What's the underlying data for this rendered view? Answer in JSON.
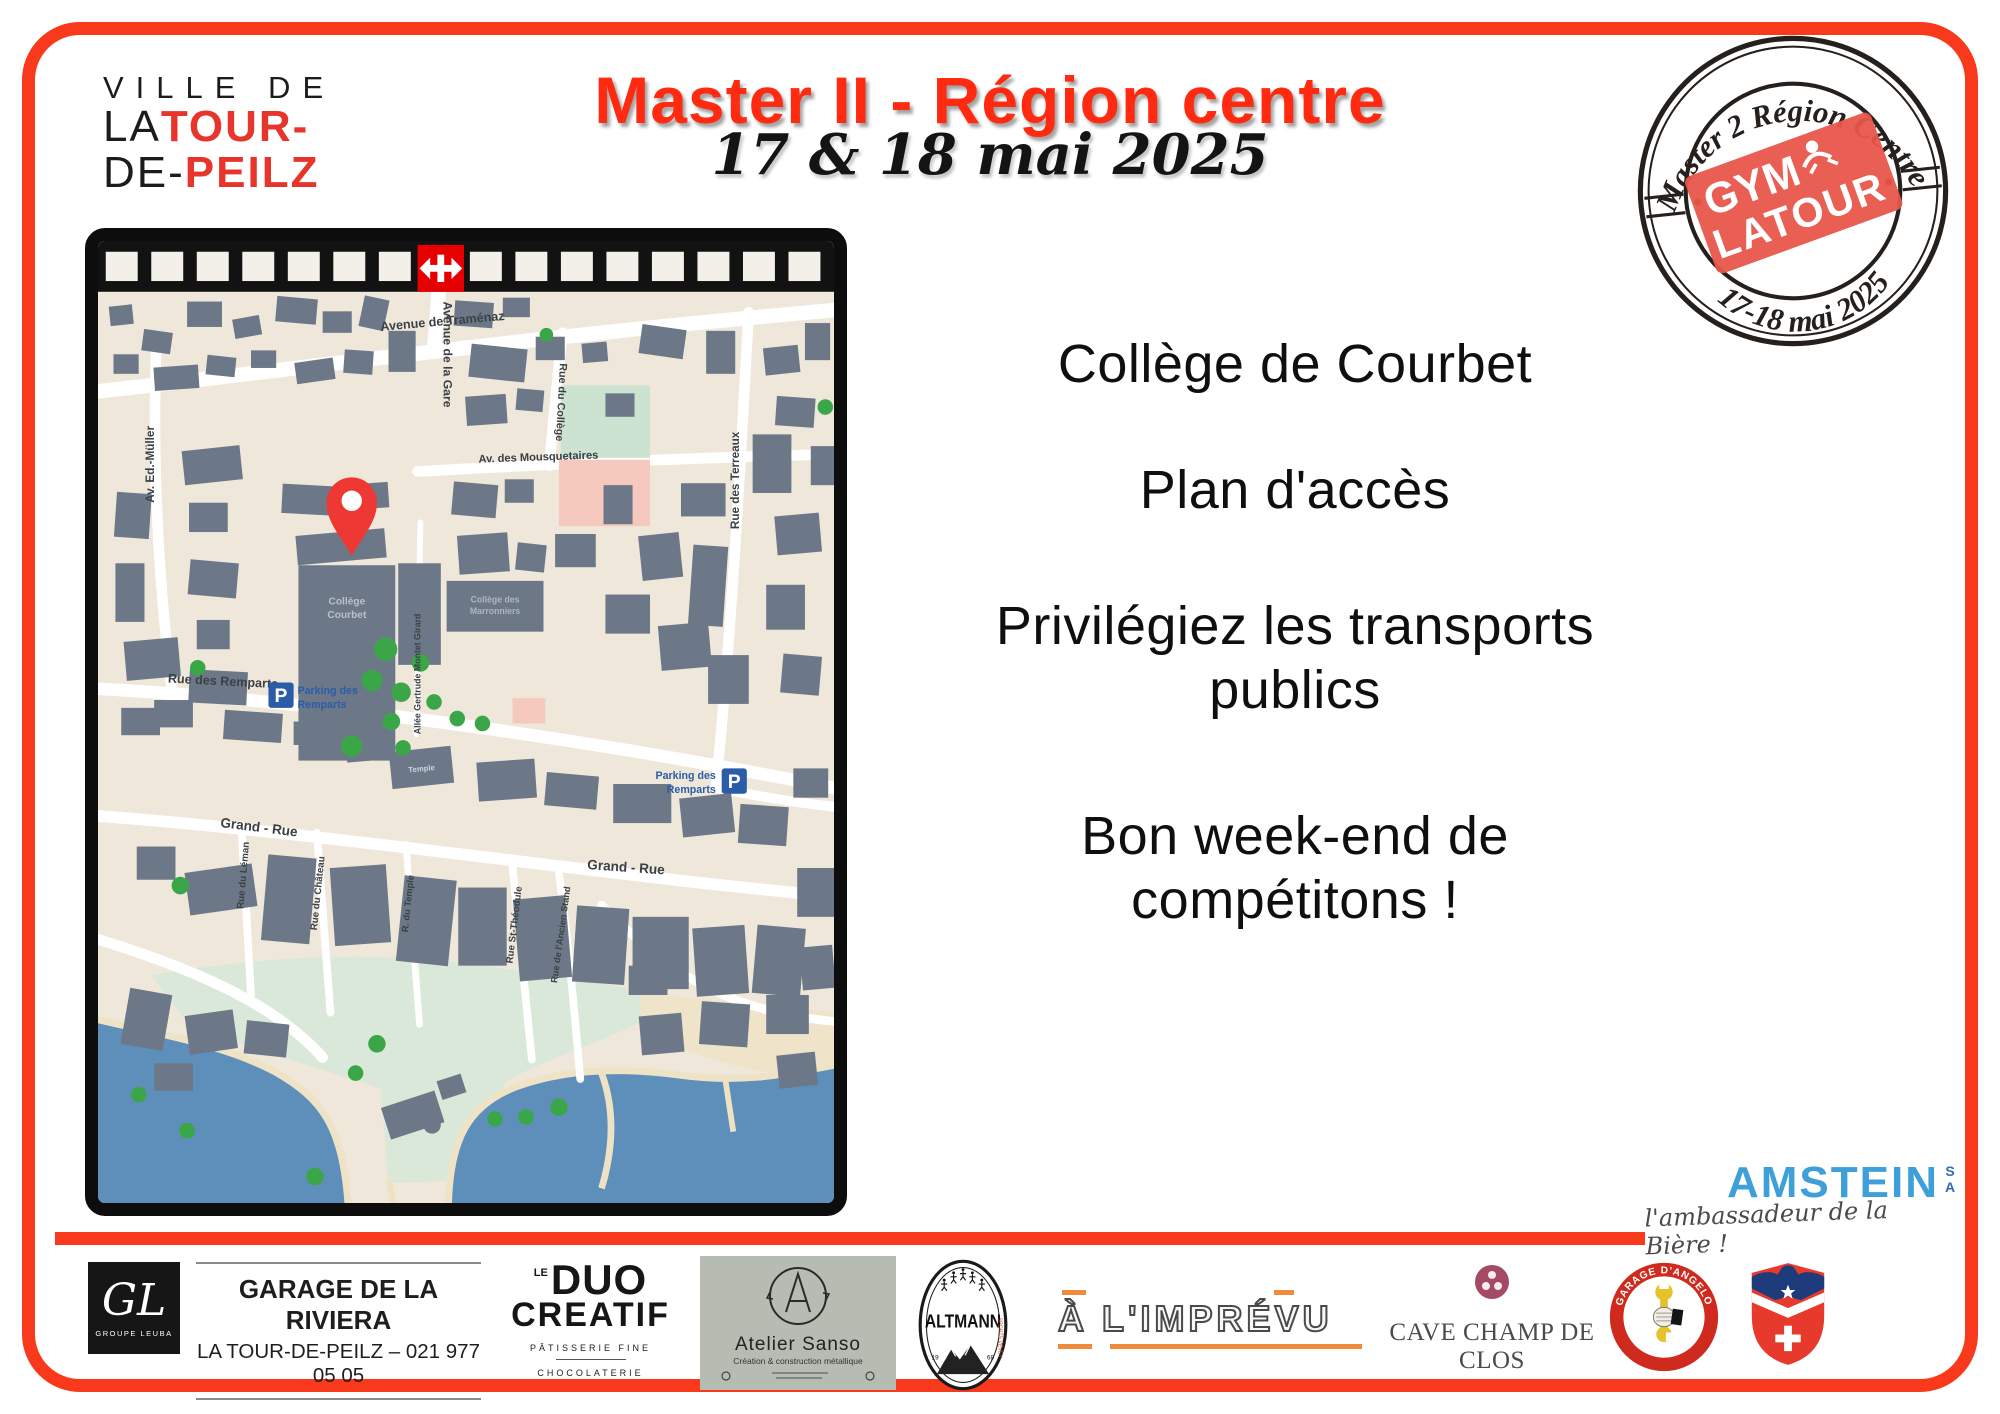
{
  "colors": {
    "accent_red": "#F9391B",
    "title_red": "#FF2A10",
    "stamp_red": "#E9564A",
    "parking_blue": "#2A5CA8",
    "amstein_blue": "#3F9FD8",
    "lake_blue": "#5D8FBA",
    "building_gray": "#6C7888",
    "map_beige": "#EEE7DA",
    "tree_green": "#3BA648",
    "imprevu_orange": "#F08A3C"
  },
  "city_logo": {
    "line1": "VILLE DE",
    "la": "LA",
    "tour": "TOUR-",
    "de": "DE-",
    "peilz": "PEILZ"
  },
  "title": "Master II - Région centre",
  "date": "17 & 18 mai 2025",
  "stamp": {
    "arc_top": "Master 2 Région Centre",
    "badge_gym": "GYM",
    "badge_latour": "LATOUR",
    "arc_bottom": "17-18 mai 2025"
  },
  "map": {
    "streets": {
      "gare": "Avenue de la Gare",
      "tramenaz": "Avenue de Traménaz",
      "rue_college": "Rue du Collège",
      "mousquetaires": "Av. des Mousquetaires",
      "ed_muller": "Av. Ed.-Müller",
      "terreaux": "Rue des Terreaux",
      "allee": "Allée Gertrude Montet Girard",
      "remparts": "Rue des Remparts",
      "grand_rue_1": "Grand - Rue",
      "grand_rue_2": "Grand - Rue",
      "leman": "Rue du Léman",
      "chateau": "Rue du Château",
      "r_temple": "R. du Temple",
      "st_theodule": "Rue St-Théodule",
      "ancien_stand": "Rue de l'Ancien Stand"
    },
    "places": {
      "courbet_1": "Collège",
      "courbet_2": "Courbet",
      "marronniers_1": "Collège des",
      "marronniers_2": "Marronniers",
      "temple": "Temple",
      "parking_p": "P",
      "parking_1": "Parking des",
      "parking_2": "Remparts"
    }
  },
  "main_text": {
    "venue": "Collège de Courbet",
    "plan": "Plan d'accès",
    "transport": "Privilégiez les transports publics",
    "wish": "Bon week-end de compétitons !"
  },
  "sponsors": {
    "amstein": {
      "name": "AMSTEIN",
      "sa": "SA",
      "tagline": "l'ambassadeur de la Bière !"
    },
    "riviera": {
      "monogram": "GL",
      "group": "GROUPE LEUBA",
      "name": "GARAGE DE LA RIVIERA",
      "info": "LA TOUR-DE-PEILZ – 021 977 05 05"
    },
    "duo": {
      "le": "LE",
      "duo": "DUO",
      "creatif": "CREATIF",
      "sub1": "PÂTISSERIE FINE",
      "sub2": "CHOCOLATERIE"
    },
    "sanso": {
      "name": "Atelier Sanso",
      "sub": "Création & construction métallique"
    },
    "altmann": {
      "name": "ALTMANN",
      "sports": "SPORTS VEVEY",
      "y1": "19",
      "y2": "68"
    },
    "imprevu": {
      "name": "À L'IMPRÉVU"
    },
    "cave": {
      "name": "CAVE CHAMP DE CLOS"
    },
    "angelo": {
      "arc_top": "GARAGE D'ANGELO",
      "arc_bottom": "& PRODUIT"
    }
  }
}
